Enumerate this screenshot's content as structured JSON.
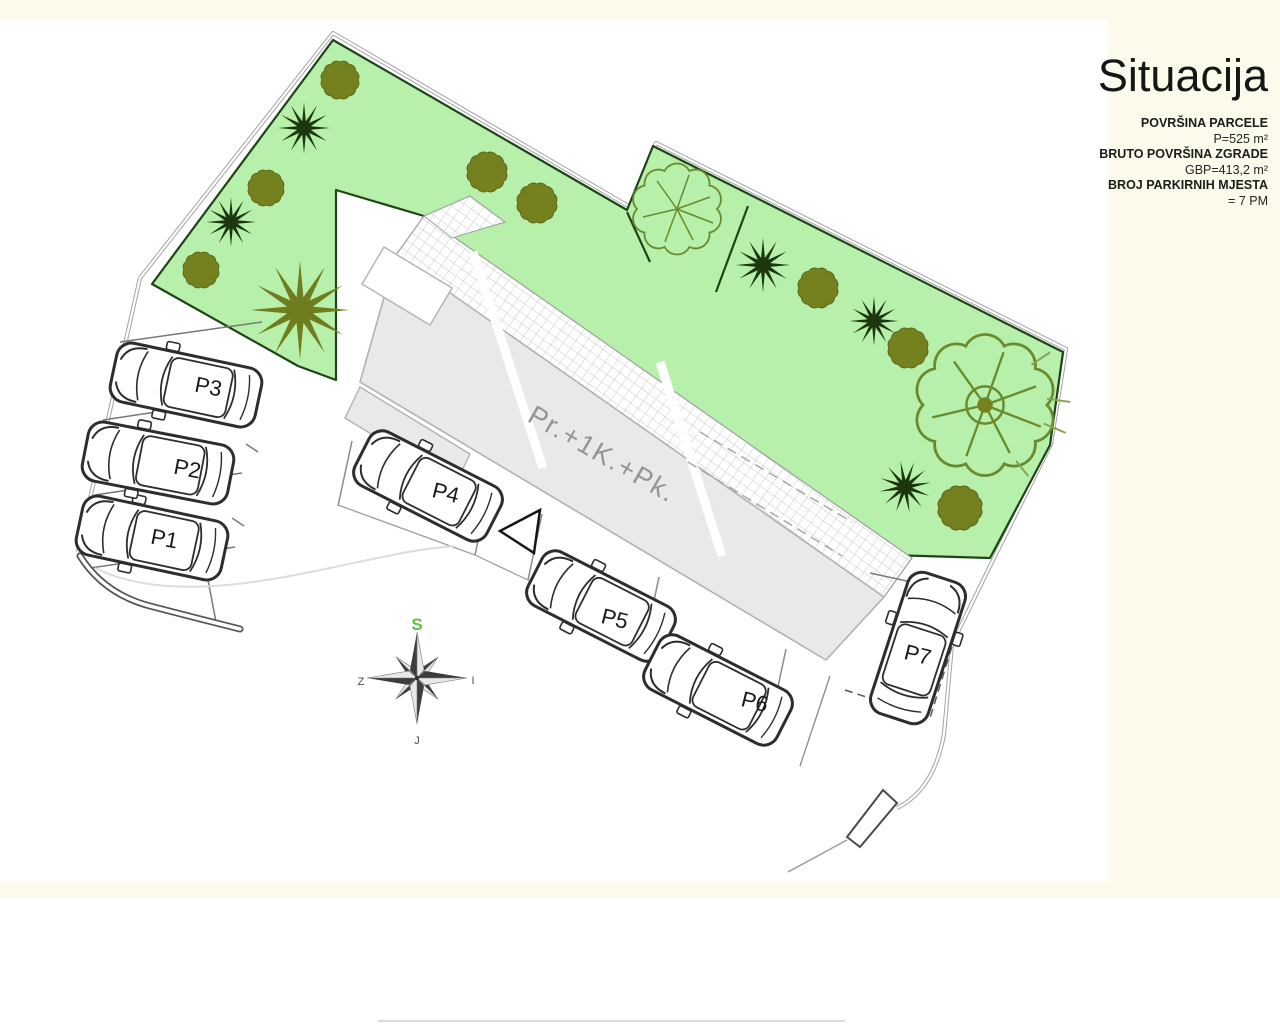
{
  "canvas": {
    "background": "#fbfaeb",
    "sheet": "#ffffff"
  },
  "title_block": {
    "title": "Situacija",
    "info": [
      {
        "label": "POVRŠINA PARCELE",
        "value": "P=525 m²"
      },
      {
        "label": "BRUTO POVRŠINA ZGRADE",
        "value": "GBP=413,2 m²"
      },
      {
        "label": "BROJ PARKIRNIH MJESTA",
        "value": "= 7 PM"
      }
    ]
  },
  "plan": {
    "building_label": "Pr.+1K.+Pk.",
    "parking_labels": [
      "P1",
      "P2",
      "P3",
      "P4",
      "P5",
      "P6",
      "P7"
    ],
    "compass": {
      "north": "S",
      "east": "I",
      "south": "J",
      "west": "Z"
    },
    "colors": {
      "lawn": "#b7f0ab",
      "lawn_border": "#1e4418",
      "tree_olive": "#75801f",
      "shrub_dark": "#1c370e",
      "outline_tree": "#6a8a2e",
      "building_fill": "#e9e9e9",
      "building_stroke": "#b2b2b2",
      "tile_line": "#c9c9c9",
      "boundary": "#a3a3a3",
      "car_stroke": "#2d2d2d",
      "compass_north": "#57c043",
      "parking_label": "#1a1a1a",
      "building_label": "#949494"
    }
  }
}
